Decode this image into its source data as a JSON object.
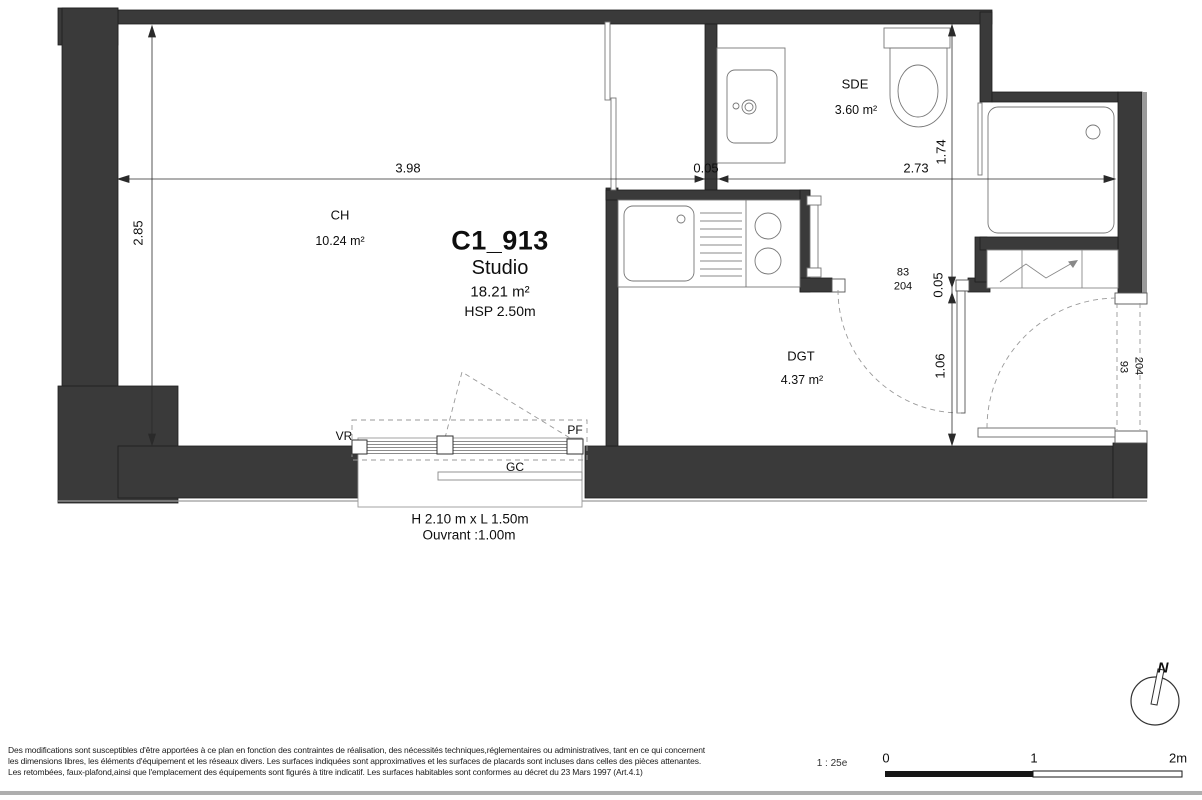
{
  "unit": {
    "id": "C1_913",
    "type": "Studio",
    "area": "18.21 m²",
    "ceiling_height": "HSP 2.50m"
  },
  "rooms": {
    "ch": {
      "name": "CH",
      "area": "10.24 m²"
    },
    "sde": {
      "name": "SDE",
      "area": "3.60 m²"
    },
    "dgt": {
      "name": "DGT",
      "area": "4.37 m²"
    }
  },
  "dimensions": {
    "ch_width": "3.98",
    "partition_thickness": "0.05",
    "sde_width": "2.73",
    "sde_depth": "1.74",
    "dgt_wall_thickness": "0.05",
    "dgt_height": "1.06",
    "ch_depth": "2.85"
  },
  "doors": {
    "interior": {
      "width": "83",
      "height": "204"
    },
    "entrance": {
      "width": "93",
      "height": "204"
    }
  },
  "window": {
    "label_left": "VR",
    "label_right": "PF",
    "label_rail": "GC",
    "size": "H 2.10 m x  L 1.50m",
    "opening": "Ouvrant :1.00m"
  },
  "compass": {
    "north_label": "N"
  },
  "scale_bar": {
    "ratio": "1 : 25e",
    "tick_0": "0",
    "tick_1": "1",
    "tick_2": "2m"
  },
  "footer": {
    "line_1": "Des modifications sont susceptibles d'être apportées à ce plan en fonction des contraintes de réalisation, des nécessités techniques,réglementaires ou administratives, tant en ce qui concernent",
    "line_2": "les dimensions libres, les éléments d'équipement et les réseaux divers. Les surfaces indiquées sont approximatives et les surfaces de placards sont incluses dans celles des pièces attenantes.",
    "line_3": "Les retombées, faux-plafond,ainsi que l'emplacement des équipements sont figurés à titre indicatif. Les surfaces habitables sont conformes au décret du 23 Mars 1997 (Art.4.1)"
  }
}
